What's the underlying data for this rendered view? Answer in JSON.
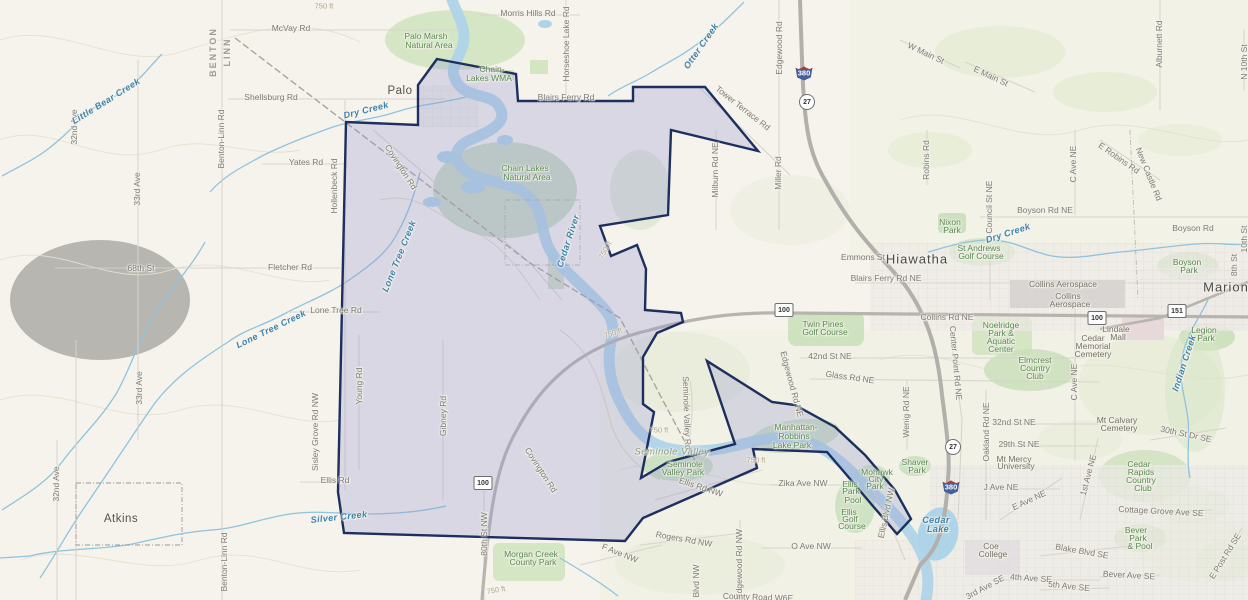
{
  "map": {
    "type": "topographic-basemap-with-selection-polygon",
    "colors": {
      "selection_fill": "#9498cc",
      "selection_stroke": "#1c2f5e",
      "water": "#b2d6e9",
      "park_green": "#cfe3bd",
      "terrain": "#f5f3ec"
    },
    "shields": [
      {
        "kind": "interstate",
        "num": "380",
        "x": 804,
        "y": 73
      },
      {
        "kind": "interstate",
        "num": "380",
        "x": 951,
        "y": 487
      },
      {
        "kind": "circle",
        "num": "27",
        "x": 807,
        "y": 102
      },
      {
        "kind": "circle",
        "num": "27",
        "x": 953,
        "y": 447
      },
      {
        "kind": "rect",
        "num": "100",
        "x": 784,
        "y": 310
      },
      {
        "kind": "rect",
        "num": "100",
        "x": 1097,
        "y": 318
      },
      {
        "kind": "rect",
        "num": "100",
        "x": 483,
        "y": 483
      },
      {
        "kind": "rect",
        "num": "151",
        "x": 1177,
        "y": 311
      }
    ],
    "labels": [
      {
        "text": "BENTON",
        "x": 213,
        "y": 52,
        "r": -90,
        "t": "county"
      },
      {
        "text": "LINN",
        "x": 227,
        "y": 52,
        "r": -90,
        "t": "county"
      },
      {
        "text": "Palo",
        "x": 400,
        "y": 91,
        "t": "town"
      },
      {
        "text": "Atkins",
        "x": 121,
        "y": 519,
        "t": "town"
      },
      {
        "text": "Hiawatha",
        "x": 917,
        "y": 259,
        "t": "city"
      },
      {
        "text": "Marion",
        "x": 1226,
        "y": 287,
        "t": "city"
      },
      {
        "text": "McVay Rd",
        "x": 291,
        "y": 28,
        "t": "road"
      },
      {
        "text": "Morris Hills Rd",
        "x": 528,
        "y": 13,
        "t": "road"
      },
      {
        "text": "Horseshoe Lake Rd",
        "x": 566,
        "y": 44,
        "r": -90,
        "t": "road"
      },
      {
        "text": "Blairs Ferry Rd",
        "x": 566,
        "y": 97,
        "t": "road"
      },
      {
        "text": "Tower Terrace Rd",
        "x": 743,
        "y": 108,
        "r": 38,
        "t": "road"
      },
      {
        "text": "Edgewood Rd",
        "x": 779,
        "y": 48,
        "r": -90,
        "t": "road"
      },
      {
        "text": "W Main St",
        "x": 926,
        "y": 53,
        "r": 25,
        "t": "road"
      },
      {
        "text": "E Main St",
        "x": 991,
        "y": 76,
        "r": 25,
        "t": "road"
      },
      {
        "text": "Alburnett Rd",
        "x": 1159,
        "y": 44,
        "r": -90,
        "t": "road"
      },
      {
        "text": "N 10th St",
        "x": 1244,
        "y": 62,
        "r": -90,
        "t": "road"
      },
      {
        "text": "Shellsburg Rd",
        "x": 271,
        "y": 97,
        "t": "road"
      },
      {
        "text": "Yates Rd",
        "x": 306,
        "y": 162,
        "t": "road"
      },
      {
        "text": "Hollenbeck Rd",
        "x": 334,
        "y": 186,
        "r": -90,
        "t": "road"
      },
      {
        "text": "Covington Rd",
        "x": 401,
        "y": 167,
        "r": 57,
        "t": "road"
      },
      {
        "text": "Covington Rd",
        "x": 541,
        "y": 470,
        "r": 57,
        "t": "road"
      },
      {
        "text": "Fletcher Rd",
        "x": 290,
        "y": 267,
        "t": "road"
      },
      {
        "text": "68th St",
        "x": 141,
        "y": 268,
        "t": "road"
      },
      {
        "text": "Lone Tree Rd",
        "x": 336,
        "y": 310,
        "t": "road"
      },
      {
        "text": "32nd Ave",
        "x": 74,
        "y": 127,
        "r": -90,
        "t": "road"
      },
      {
        "text": "33rd Ave",
        "x": 137,
        "y": 189,
        "r": -90,
        "t": "road"
      },
      {
        "text": "33rd Ave",
        "x": 139,
        "y": 388,
        "r": -90,
        "t": "road"
      },
      {
        "text": "32nd Ave",
        "x": 56,
        "y": 484,
        "r": -90,
        "t": "road"
      },
      {
        "text": "Benton-Linn Rd",
        "x": 221,
        "y": 139,
        "r": -90,
        "t": "road"
      },
      {
        "text": "Benton-Linn Rd",
        "x": 224,
        "y": 562,
        "r": -90,
        "t": "road"
      },
      {
        "text": "Milburn Rd NE",
        "x": 715,
        "y": 170,
        "r": -90,
        "t": "road"
      },
      {
        "text": "Miller Rd",
        "x": 778,
        "y": 173,
        "r": -90,
        "t": "road"
      },
      {
        "text": "Robins Rd",
        "x": 926,
        "y": 160,
        "r": -90,
        "t": "road"
      },
      {
        "text": "C Ave NE",
        "x": 1073,
        "y": 164,
        "r": -90,
        "t": "road"
      },
      {
        "text": "E Robins Rd",
        "x": 1119,
        "y": 158,
        "r": 35,
        "t": "road"
      },
      {
        "text": "New Castle Rd",
        "x": 1149,
        "y": 174,
        "r": 68,
        "t": "road"
      },
      {
        "text": "Council St NE",
        "x": 989,
        "y": 207,
        "r": -90,
        "t": "road"
      },
      {
        "text": "Boyson Rd NE",
        "x": 1045,
        "y": 210,
        "t": "road"
      },
      {
        "text": "Boyson Rd",
        "x": 1193,
        "y": 228,
        "t": "road"
      },
      {
        "text": "10th St",
        "x": 1244,
        "y": 239,
        "r": -90,
        "t": "road"
      },
      {
        "text": "8th St",
        "x": 1234,
        "y": 265,
        "r": -90,
        "t": "road"
      },
      {
        "text": "Emmons St",
        "x": 863,
        "y": 257,
        "t": "road"
      },
      {
        "text": "Blairs Ferry Rd NE",
        "x": 886,
        "y": 278,
        "t": "road"
      },
      {
        "text": "Collins Rd NE",
        "x": 947,
        "y": 317,
        "t": "road"
      },
      {
        "text": "42nd St NE",
        "x": 830,
        "y": 356,
        "t": "road"
      },
      {
        "text": "Glass Rd NE",
        "x": 850,
        "y": 377,
        "r": 8,
        "t": "road"
      },
      {
        "text": "Edgewood Rd NE",
        "x": 792,
        "y": 384,
        "r": 75,
        "t": "road"
      },
      {
        "text": "Seminole Valley Rd",
        "x": 687,
        "y": 413,
        "r": 88,
        "t": "road"
      },
      {
        "text": "Center Point Rd NE",
        "x": 956,
        "y": 363,
        "r": 85,
        "t": "road"
      },
      {
        "text": "Wenig Rd NE",
        "x": 906,
        "y": 412,
        "r": -90,
        "t": "road"
      },
      {
        "text": "Oakland Rd NE",
        "x": 986,
        "y": 432,
        "r": -90,
        "t": "road"
      },
      {
        "text": "32nd St NE",
        "x": 1014,
        "y": 422,
        "t": "road"
      },
      {
        "text": "29th St NE",
        "x": 1019,
        "y": 444,
        "t": "road"
      },
      {
        "text": "30th St Dr SE",
        "x": 1186,
        "y": 434,
        "r": 12,
        "t": "road"
      },
      {
        "text": "C Ave NE",
        "x": 1074,
        "y": 382,
        "r": -90,
        "t": "road"
      },
      {
        "text": "Young Rd",
        "x": 359,
        "y": 386,
        "r": -90,
        "t": "road"
      },
      {
        "text": "Gibney Rd",
        "x": 443,
        "y": 416,
        "r": -90,
        "t": "road"
      },
      {
        "text": "Sisley Grove Rd NW",
        "x": 315,
        "y": 432,
        "r": -90,
        "t": "road"
      },
      {
        "text": "Ellis Rd",
        "x": 335,
        "y": 480,
        "t": "road"
      },
      {
        "text": "80th St NW",
        "x": 484,
        "y": 534,
        "r": -90,
        "t": "road"
      },
      {
        "text": "Ellis Rd NW",
        "x": 701,
        "y": 487,
        "r": 18,
        "t": "road"
      },
      {
        "text": "Zika Ave NW",
        "x": 803,
        "y": 483,
        "t": "road"
      },
      {
        "text": "O Ave NW",
        "x": 811,
        "y": 546,
        "t": "road"
      },
      {
        "text": "Rogers Rd NW",
        "x": 684,
        "y": 539,
        "r": 10,
        "t": "road"
      },
      {
        "text": "F Ave NW",
        "x": 620,
        "y": 553,
        "r": 22,
        "t": "road"
      },
      {
        "text": "Edgewood Rd NW",
        "x": 739,
        "y": 564,
        "r": -90,
        "t": "road"
      },
      {
        "text": "Blvd NW",
        "x": 696,
        "y": 581,
        "r": -90,
        "t": "road"
      },
      {
        "text": "Ellis Blvd NW",
        "x": 886,
        "y": 513,
        "r": -78,
        "t": "road"
      },
      {
        "text": "J Ave NE",
        "x": 1001,
        "y": 487,
        "t": "road"
      },
      {
        "text": "E Ave NE",
        "x": 1029,
        "y": 500,
        "r": -25,
        "t": "road"
      },
      {
        "text": "1st Ave NE",
        "x": 1088,
        "y": 475,
        "r": -75,
        "t": "road"
      },
      {
        "text": "4th Ave SE",
        "x": 1031,
        "y": 578,
        "r": 4,
        "t": "road"
      },
      {
        "text": "5th Ave SE",
        "x": 1069,
        "y": 586,
        "r": 6,
        "t": "road"
      },
      {
        "text": "3rd Ave SE",
        "x": 985,
        "y": 587,
        "r": -28,
        "t": "road"
      },
      {
        "text": "Bever Ave SE",
        "x": 1129,
        "y": 575,
        "r": 3,
        "t": "road"
      },
      {
        "text": "Blake Blvd SE",
        "x": 1082,
        "y": 551,
        "r": 10,
        "t": "road"
      },
      {
        "text": "Cottage Grove Ave SE",
        "x": 1161,
        "y": 511,
        "r": 3,
        "t": "road"
      },
      {
        "text": "E Post Rd SE",
        "x": 1225,
        "y": 556,
        "r": -58,
        "t": "road"
      },
      {
        "text": "County Road W6E",
        "x": 758,
        "y": 597,
        "r": 2,
        "t": "road"
      },
      {
        "text": "Dry Creek",
        "x": 366,
        "y": 110,
        "r": -14,
        "t": "water"
      },
      {
        "text": "Little Bear Creek",
        "x": 106,
        "y": 101,
        "r": -32,
        "t": "water"
      },
      {
        "text": "Lone Tree Creek",
        "x": 399,
        "y": 256,
        "r": -68,
        "t": "water"
      },
      {
        "text": "Lone Tree Creek",
        "x": 271,
        "y": 329,
        "r": -26,
        "t": "water"
      },
      {
        "text": "Cedar River",
        "x": 568,
        "y": 241,
        "r": -72,
        "t": "water"
      },
      {
        "text": "Silver Creek",
        "x": 339,
        "y": 517,
        "r": -6,
        "t": "water"
      },
      {
        "text": "Otter Creek",
        "x": 701,
        "y": 46,
        "r": -55,
        "t": "water"
      },
      {
        "text": "Dry Creek",
        "x": 1008,
        "y": 233,
        "r": -18,
        "t": "water"
      },
      {
        "text": "Indian Creek",
        "x": 1184,
        "y": 363,
        "r": -72,
        "t": "water"
      },
      {
        "text": "Cedar",
        "x": 936,
        "y": 520,
        "t": "water"
      },
      {
        "text": "Lake",
        "x": 938,
        "y": 529,
        "t": "water"
      },
      {
        "text": "Palo Marsh",
        "x": 426,
        "y": 36,
        "t": "park"
      },
      {
        "text": "Natural Area",
        "x": 429,
        "y": 45,
        "t": "park"
      },
      {
        "text": "Chain-",
        "x": 492,
        "y": 69,
        "t": "park"
      },
      {
        "text": "Lakes WMA",
        "x": 489,
        "y": 78,
        "t": "park"
      },
      {
        "text": "Chain Lakes",
        "x": 525,
        "y": 168,
        "t": "park"
      },
      {
        "text": "Natural Area",
        "x": 527,
        "y": 177,
        "t": "park"
      },
      {
        "text": "Nixon",
        "x": 950,
        "y": 222,
        "t": "park"
      },
      {
        "text": "Park",
        "x": 952,
        "y": 230,
        "t": "park"
      },
      {
        "text": "St Andrews",
        "x": 979,
        "y": 248,
        "t": "park"
      },
      {
        "text": "Golf Course",
        "x": 981,
        "y": 256,
        "t": "park"
      },
      {
        "text": "Boyson",
        "x": 1187,
        "y": 262,
        "t": "park"
      },
      {
        "text": "Park",
        "x": 1189,
        "y": 270,
        "t": "park"
      },
      {
        "text": "Twin Pines",
        "x": 823,
        "y": 324,
        "t": "park"
      },
      {
        "text": "Golf Course",
        "x": 825,
        "y": 332,
        "t": "park"
      },
      {
        "text": "Noelridge",
        "x": 1001,
        "y": 325,
        "t": "park"
      },
      {
        "text": "Park &",
        "x": 1001,
        "y": 333,
        "t": "park"
      },
      {
        "text": "Aquatic",
        "x": 1001,
        "y": 341,
        "t": "park"
      },
      {
        "text": "Center",
        "x": 1001,
        "y": 349,
        "t": "park"
      },
      {
        "text": "Lindale",
        "x": 1116,
        "y": 329,
        "t": "poi"
      },
      {
        "text": "Mall",
        "x": 1118,
        "y": 337,
        "t": "poi"
      },
      {
        "text": "Cedar",
        "x": 1093,
        "y": 338,
        "t": "poi"
      },
      {
        "text": "Memorial",
        "x": 1093,
        "y": 346,
        "t": "poi"
      },
      {
        "text": "Cemetery",
        "x": 1093,
        "y": 354,
        "t": "poi"
      },
      {
        "text": "Legion",
        "x": 1204,
        "y": 330,
        "t": "park"
      },
      {
        "text": "Park",
        "x": 1206,
        "y": 338,
        "t": "park"
      },
      {
        "text": "Elmcrest",
        "x": 1035,
        "y": 360,
        "t": "park"
      },
      {
        "text": "Country",
        "x": 1035,
        "y": 368,
        "t": "park"
      },
      {
        "text": "Club",
        "x": 1035,
        "y": 376,
        "t": "park"
      },
      {
        "text": "Manhattan-",
        "x": 796,
        "y": 427,
        "t": "park"
      },
      {
        "text": "Robbins",
        "x": 794,
        "y": 436,
        "t": "park"
      },
      {
        "text": "Lake Park",
        "x": 792,
        "y": 445,
        "t": "park"
      },
      {
        "text": "Seminole Valley",
        "x": 672,
        "y": 452,
        "t": "valley"
      },
      {
        "text": "Seminole",
        "x": 685,
        "y": 464,
        "t": "park"
      },
      {
        "text": "Valley Park",
        "x": 683,
        "y": 472,
        "t": "park"
      },
      {
        "text": "Mohawk",
        "x": 877,
        "y": 472,
        "t": "park"
      },
      {
        "text": "City",
        "x": 876,
        "y": 479,
        "t": "park"
      },
      {
        "text": "Park",
        "x": 875,
        "y": 486,
        "t": "park"
      },
      {
        "text": "Shaver",
        "x": 915,
        "y": 462,
        "t": "park"
      },
      {
        "text": "Park",
        "x": 917,
        "y": 470,
        "t": "park"
      },
      {
        "text": "Ellis",
        "x": 850,
        "y": 484,
        "t": "park"
      },
      {
        "text": "Park",
        "x": 851,
        "y": 491,
        "t": "park"
      },
      {
        "text": "Pool",
        "x": 853,
        "y": 500,
        "t": "park"
      },
      {
        "text": "Ellis",
        "x": 849,
        "y": 512,
        "t": "park"
      },
      {
        "text": "Golf",
        "x": 850,
        "y": 519,
        "t": "park"
      },
      {
        "text": "Course",
        "x": 852,
        "y": 526,
        "t": "park"
      },
      {
        "text": "Morgan Creek",
        "x": 531,
        "y": 554,
        "t": "park"
      },
      {
        "text": "County Park",
        "x": 533,
        "y": 562,
        "t": "park"
      },
      {
        "text": "Cedar",
        "x": 1139,
        "y": 464,
        "t": "park"
      },
      {
        "text": "Rapids",
        "x": 1141,
        "y": 472,
        "t": "park"
      },
      {
        "text": "Country",
        "x": 1141,
        "y": 480,
        "t": "park"
      },
      {
        "text": "Club",
        "x": 1143,
        "y": 488,
        "t": "park"
      },
      {
        "text": "Bever",
        "x": 1136,
        "y": 530,
        "t": "park"
      },
      {
        "text": "Park",
        "x": 1138,
        "y": 538,
        "t": "park"
      },
      {
        "text": "& Pool",
        "x": 1140,
        "y": 546,
        "t": "park"
      },
      {
        "text": "Collins Aerospace",
        "x": 1063,
        "y": 284,
        "t": "poi"
      },
      {
        "text": "Collins",
        "x": 1068,
        "y": 296,
        "t": "poi"
      },
      {
        "text": "Aerospace",
        "x": 1070,
        "y": 304,
        "t": "poi"
      },
      {
        "text": "Mt Mercy",
        "x": 1014,
        "y": 459,
        "t": "poi"
      },
      {
        "text": "University",
        "x": 1016,
        "y": 466,
        "t": "poi"
      },
      {
        "text": "Coe",
        "x": 991,
        "y": 546,
        "t": "poi"
      },
      {
        "text": "College",
        "x": 993,
        "y": 554,
        "t": "poi"
      },
      {
        "text": "Mt Calvary",
        "x": 1117,
        "y": 420,
        "t": "poi"
      },
      {
        "text": "Cemetery",
        "x": 1119,
        "y": 428,
        "t": "poi"
      },
      {
        "text": "750 ft",
        "x": 324,
        "y": 6,
        "t": "contour"
      },
      {
        "text": "750 ft",
        "x": 605,
        "y": 250,
        "r": -62,
        "t": "contour"
      },
      {
        "text": "750 ft",
        "x": 613,
        "y": 333,
        "r": -18,
        "t": "contour"
      },
      {
        "text": "750 ft",
        "x": 659,
        "y": 430,
        "t": "contour"
      },
      {
        "text": "750 ft",
        "x": 756,
        "y": 460,
        "t": "contour"
      },
      {
        "text": "750 ft",
        "x": 496,
        "y": 590,
        "r": -10,
        "t": "contour"
      }
    ]
  }
}
